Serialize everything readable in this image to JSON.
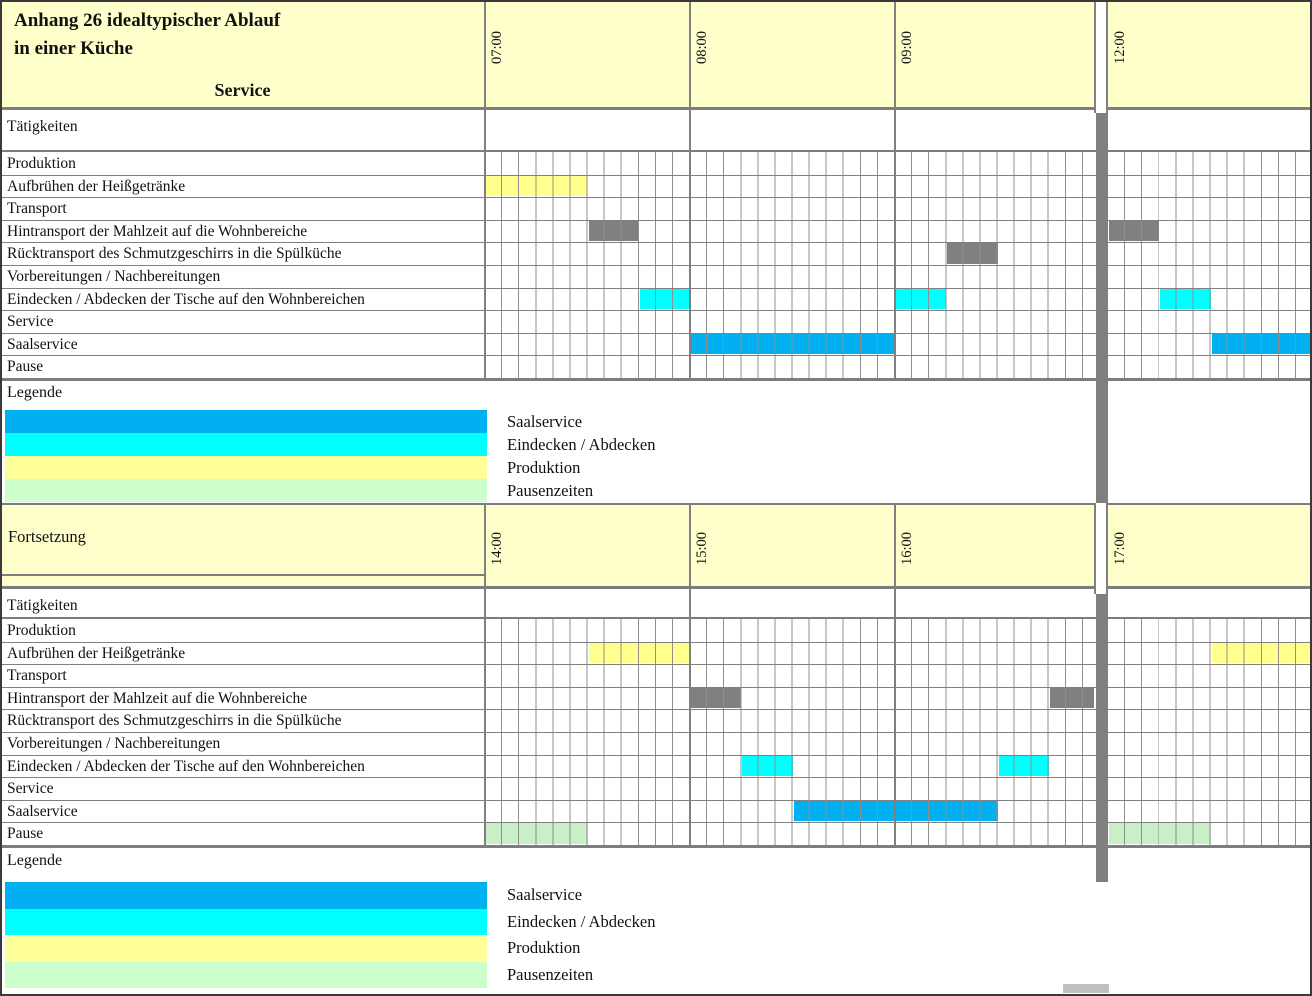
{
  "colors": {
    "page_bg": "#FFFFFF",
    "header_bg": "#FFFFCC",
    "grid_line": "#8F8F8F",
    "border": "#808080",
    "thick_border": "#7D7D7D",
    "break_bar": "#808080",
    "bar": {
      "produktion": "#FFFF8C",
      "transport": "#808080",
      "eindecken": "#00FFFF",
      "saalservice": "#00B0F0",
      "pause": "#C9EFC9"
    }
  },
  "section1_header": {
    "title_line1": "Anhang 26 idealtypischer Ablauf",
    "title_line2": "in einer Küche",
    "subtitle": "Service"
  },
  "section2_header": {
    "title": "Fortsetzung"
  },
  "legend": {
    "title": "Legende",
    "items": [
      {
        "label": "Saalservice",
        "color": "#00B0F0"
      },
      {
        "label": "Eindecken / Abdecken",
        "color": "#00FFFF"
      },
      {
        "label": "Produktion",
        "color": "#FFFF99"
      },
      {
        "label": "Pausenzeiten",
        "color": "#CCFFCC"
      }
    ]
  },
  "chart_data": [
    {
      "type": "gantt",
      "section": "Service",
      "time_labels": [
        "07:00",
        "08:00",
        "09:00",
        "12:00"
      ],
      "minutes_per_cell": 5,
      "cells_per_hour": 12,
      "axis_break": {
        "between": [
          "10:00",
          "12:00"
        ],
        "marker": "gray-bar"
      },
      "rows": [
        {
          "label": "Tätigkeiten",
          "kind": "header",
          "bars": []
        },
        {
          "label": "Produktion",
          "bars": []
        },
        {
          "label": "Aufbrühen der Heißgetränke",
          "bars": [
            {
              "start": "07:00",
              "end": "07:30",
              "category": "produktion"
            }
          ]
        },
        {
          "label": "Transport",
          "bars": []
        },
        {
          "label": "Hintransport der Mahlzeit auf die Wohnbereiche",
          "bars": [
            {
              "start": "07:30",
              "end": "07:45",
              "category": "transport"
            },
            {
              "start": "12:00",
              "end": "12:15",
              "category": "transport"
            }
          ]
        },
        {
          "label": "Rücktransport des Schmutzgeschirrs in die Spülküche",
          "bars": [
            {
              "start": "09:15",
              "end": "09:30",
              "category": "transport"
            }
          ]
        },
        {
          "label": "Vorbereitungen / Nachbereitungen",
          "bars": []
        },
        {
          "label": "Eindecken / Abdecken der Tische auf den Wohnbereichen",
          "bars": [
            {
              "start": "07:45",
              "end": "08:00",
              "category": "eindecken"
            },
            {
              "start": "09:00",
              "end": "09:15",
              "category": "eindecken"
            },
            {
              "start": "12:15",
              "end": "12:30",
              "category": "eindecken"
            }
          ]
        },
        {
          "label": "Service",
          "bars": []
        },
        {
          "label": "Saalservice",
          "bars": [
            {
              "start": "08:00",
              "end": "09:00",
              "category": "saalservice"
            },
            {
              "start": "12:30",
              "end": "13:00",
              "category": "saalservice"
            }
          ]
        },
        {
          "label": "Pause",
          "bars": []
        }
      ]
    },
    {
      "type": "gantt",
      "section": "Fortsetzung",
      "time_labels": [
        "14:00",
        "15:00",
        "16:00",
        "17:00"
      ],
      "minutes_per_cell": 5,
      "cells_per_hour": 12,
      "axis_break": {
        "between": [
          "17:00",
          "17:00"
        ],
        "marker": "gray-bar"
      },
      "rows": [
        {
          "label": "Tätigkeiten",
          "kind": "header",
          "bars": []
        },
        {
          "label": "Produktion",
          "bars": []
        },
        {
          "label": "Aufbrühen der Heißgetränke",
          "bars": [
            {
              "start": "14:30",
              "end": "15:00",
              "category": "produktion"
            },
            {
              "start": "17:30",
              "end": "18:00",
              "category": "produktion"
            }
          ]
        },
        {
          "label": "Transport",
          "bars": []
        },
        {
          "label": "Hintransport der Mahlzeit auf die Wohnbereiche",
          "bars": [
            {
              "start": "15:00",
              "end": "15:15",
              "category": "transport"
            },
            {
              "start": "16:45",
              "end": "17:00",
              "category": "transport"
            }
          ]
        },
        {
          "label": "Rücktransport des Schmutzgeschirrs in die Spülküche",
          "bars": []
        },
        {
          "label": "Vorbereitungen / Nachbereitungen",
          "bars": []
        },
        {
          "label": "Eindecken / Abdecken der Tische auf den Wohnbereichen",
          "bars": [
            {
              "start": "15:15",
              "end": "15:30",
              "category": "eindecken"
            },
            {
              "start": "16:30",
              "end": "16:45",
              "category": "eindecken"
            }
          ]
        },
        {
          "label": "Service",
          "bars": []
        },
        {
          "label": "Saalservice",
          "bars": [
            {
              "start": "15:30",
              "end": "16:30",
              "category": "saalservice"
            }
          ]
        },
        {
          "label": "Pause",
          "bars": [
            {
              "start": "14:00",
              "end": "14:30",
              "category": "pause"
            },
            {
              "start": "17:00",
              "end": "17:30",
              "category": "pause"
            }
          ]
        }
      ]
    }
  ]
}
